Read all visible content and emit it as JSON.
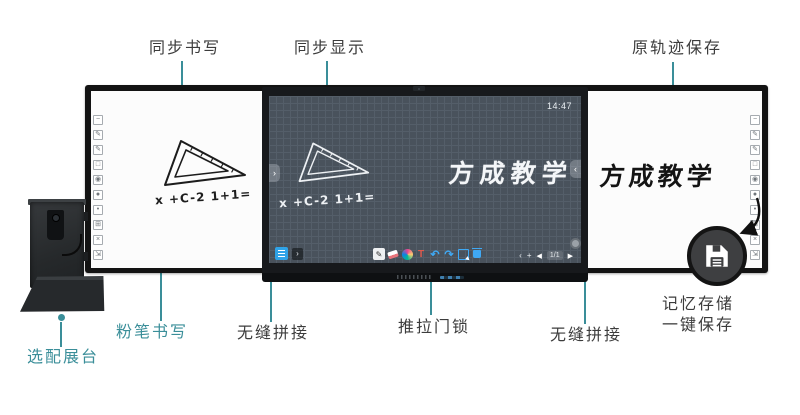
{
  "colors": {
    "teal_accent": "#3a8e99",
    "label_text": "#3c3c3c",
    "board_frame": "#131313",
    "lcd_background": "#49525c",
    "toolbar_blue": "#2fa3e8",
    "text_tool_red": "#e05a4e",
    "save_badge": "#3e3f41"
  },
  "annotations": {
    "sync_writing": "同步书写",
    "sync_display": "同步显示",
    "trace_save": "原轨迹保存",
    "optional_stand": "选配展台",
    "chalk_writing": "粉笔书写",
    "seamless_left": "无缝拼接",
    "door_lock": "推拉门锁",
    "seamless_right": "无缝拼接",
    "memory_save_line1": "记忆存储",
    "memory_save_line2": "一键保存"
  },
  "board": {
    "left_panel": {
      "formula": "x +C-2 1+1="
    },
    "screen": {
      "clock": "14:47",
      "formula": "x +C-2 1+1=",
      "brand_text": "方成教学",
      "toolbar": {
        "tools": [
          "pen",
          "eraser",
          "palette",
          "text",
          "undo",
          "redo",
          "select",
          "delete"
        ],
        "pen_glyph": "✎",
        "text_tool": "T",
        "undo_glyph": "↶",
        "redo_glyph": "↷",
        "expand_glyph": "›",
        "nav_prev": "‹",
        "nav_add": "+",
        "page_back": "◀",
        "page_indicator": "1/1",
        "page_forward": "▶",
        "panel_toggle_left": "›",
        "panel_toggle_right": "‹"
      }
    },
    "right_panel": {
      "brand_text": "方成教学"
    },
    "side_toolbar": [
      "−",
      "✎",
      "✎",
      "□",
      "◉",
      "●",
      "•",
      "⊞",
      "×",
      "⇲"
    ],
    "save_icon": "floppy-disk"
  }
}
